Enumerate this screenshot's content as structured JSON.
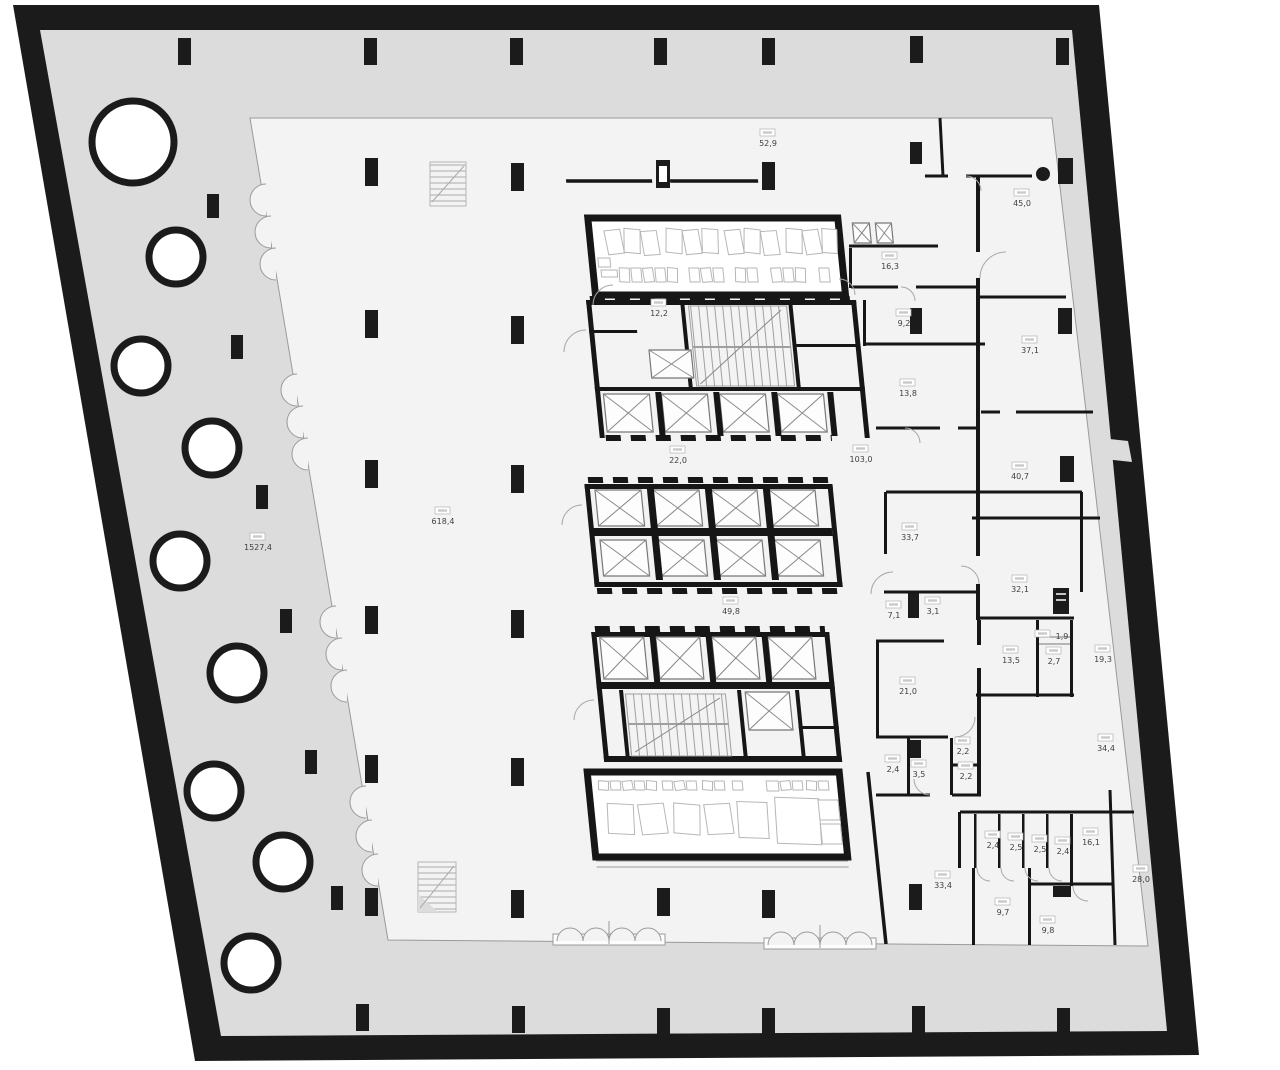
{
  "plan": {
    "type": "architectural-floor-plan",
    "area_labels": [
      {
        "id": "a-52-9",
        "value": "52,9",
        "x": 768,
        "y": 143
      },
      {
        "id": "a-45-0",
        "value": "45,0",
        "x": 1022,
        "y": 203
      },
      {
        "id": "a-16-3",
        "value": "16,3",
        "x": 890,
        "y": 266
      },
      {
        "id": "a-12-2",
        "value": "12,2",
        "x": 659,
        "y": 313
      },
      {
        "id": "a-9-2",
        "value": "9,2",
        "x": 904,
        "y": 323
      },
      {
        "id": "a-37-1",
        "value": "37,1",
        "x": 1030,
        "y": 350
      },
      {
        "id": "a-13-8",
        "value": "13,8",
        "x": 908,
        "y": 393
      },
      {
        "id": "a-22-0",
        "value": "22,0",
        "x": 678,
        "y": 460
      },
      {
        "id": "a-103-0",
        "value": "103,0",
        "x": 861,
        "y": 459
      },
      {
        "id": "a-40-7",
        "value": "40,7",
        "x": 1020,
        "y": 476
      },
      {
        "id": "a-618-4",
        "value": "618,4",
        "x": 443,
        "y": 521
      },
      {
        "id": "a-1527-4",
        "value": "1527,4",
        "x": 258,
        "y": 547
      },
      {
        "id": "a-33-7",
        "value": "33,7",
        "x": 910,
        "y": 537
      },
      {
        "id": "a-32-1",
        "value": "32,1",
        "x": 1020,
        "y": 589
      },
      {
        "id": "a-7-1",
        "value": "7,1",
        "x": 894,
        "y": 615
      },
      {
        "id": "a-3-1",
        "value": "3,1",
        "x": 933,
        "y": 611
      },
      {
        "id": "a-49-8",
        "value": "49,8",
        "x": 731,
        "y": 611
      },
      {
        "id": "a-13-5",
        "value": "13,5",
        "x": 1011,
        "y": 660
      },
      {
        "id": "a-1-9",
        "value": "1,9",
        "x": 1062,
        "y": 636,
        "inline": true
      },
      {
        "id": "a-2-7",
        "value": "2,7",
        "x": 1054,
        "y": 661
      },
      {
        "id": "a-19-3",
        "value": "19,3",
        "x": 1103,
        "y": 659
      },
      {
        "id": "a-21-0",
        "value": "21,0",
        "x": 908,
        "y": 691
      },
      {
        "id": "a-2-2a",
        "value": "2,2",
        "x": 963,
        "y": 751
      },
      {
        "id": "a-2-4a",
        "value": "2,4",
        "x": 893,
        "y": 769
      },
      {
        "id": "a-3-5",
        "value": "3,5",
        "x": 919,
        "y": 774
      },
      {
        "id": "a-2-2b",
        "value": "2,2",
        "x": 966,
        "y": 776
      },
      {
        "id": "a-34-4",
        "value": "34,4",
        "x": 1106,
        "y": 748
      },
      {
        "id": "a-2-4b",
        "value": "2,4",
        "x": 993,
        "y": 845
      },
      {
        "id": "a-2-5a",
        "value": "2,5",
        "x": 1016,
        "y": 847
      },
      {
        "id": "a-2-5b",
        "value": "2,5",
        "x": 1040,
        "y": 849
      },
      {
        "id": "a-2-4c",
        "value": "2,4",
        "x": 1063,
        "y": 851
      },
      {
        "id": "a-16-1",
        "value": "16,1",
        "x": 1091,
        "y": 842
      },
      {
        "id": "a-33-4",
        "value": "33,4",
        "x": 943,
        "y": 885
      },
      {
        "id": "a-9-7",
        "value": "9,7",
        "x": 1003,
        "y": 912
      },
      {
        "id": "a-28-0",
        "value": "28,0",
        "x": 1141,
        "y": 879
      },
      {
        "id": "a-9-8",
        "value": "9,8",
        "x": 1048,
        "y": 930
      }
    ]
  },
  "colors": {
    "outer_wall": "#1b1b1b",
    "terrace": "#dcdcdc",
    "floor": "#f3f3f3",
    "thin_line": "#9a9a9a",
    "label_text": "#3f3f3f"
  }
}
